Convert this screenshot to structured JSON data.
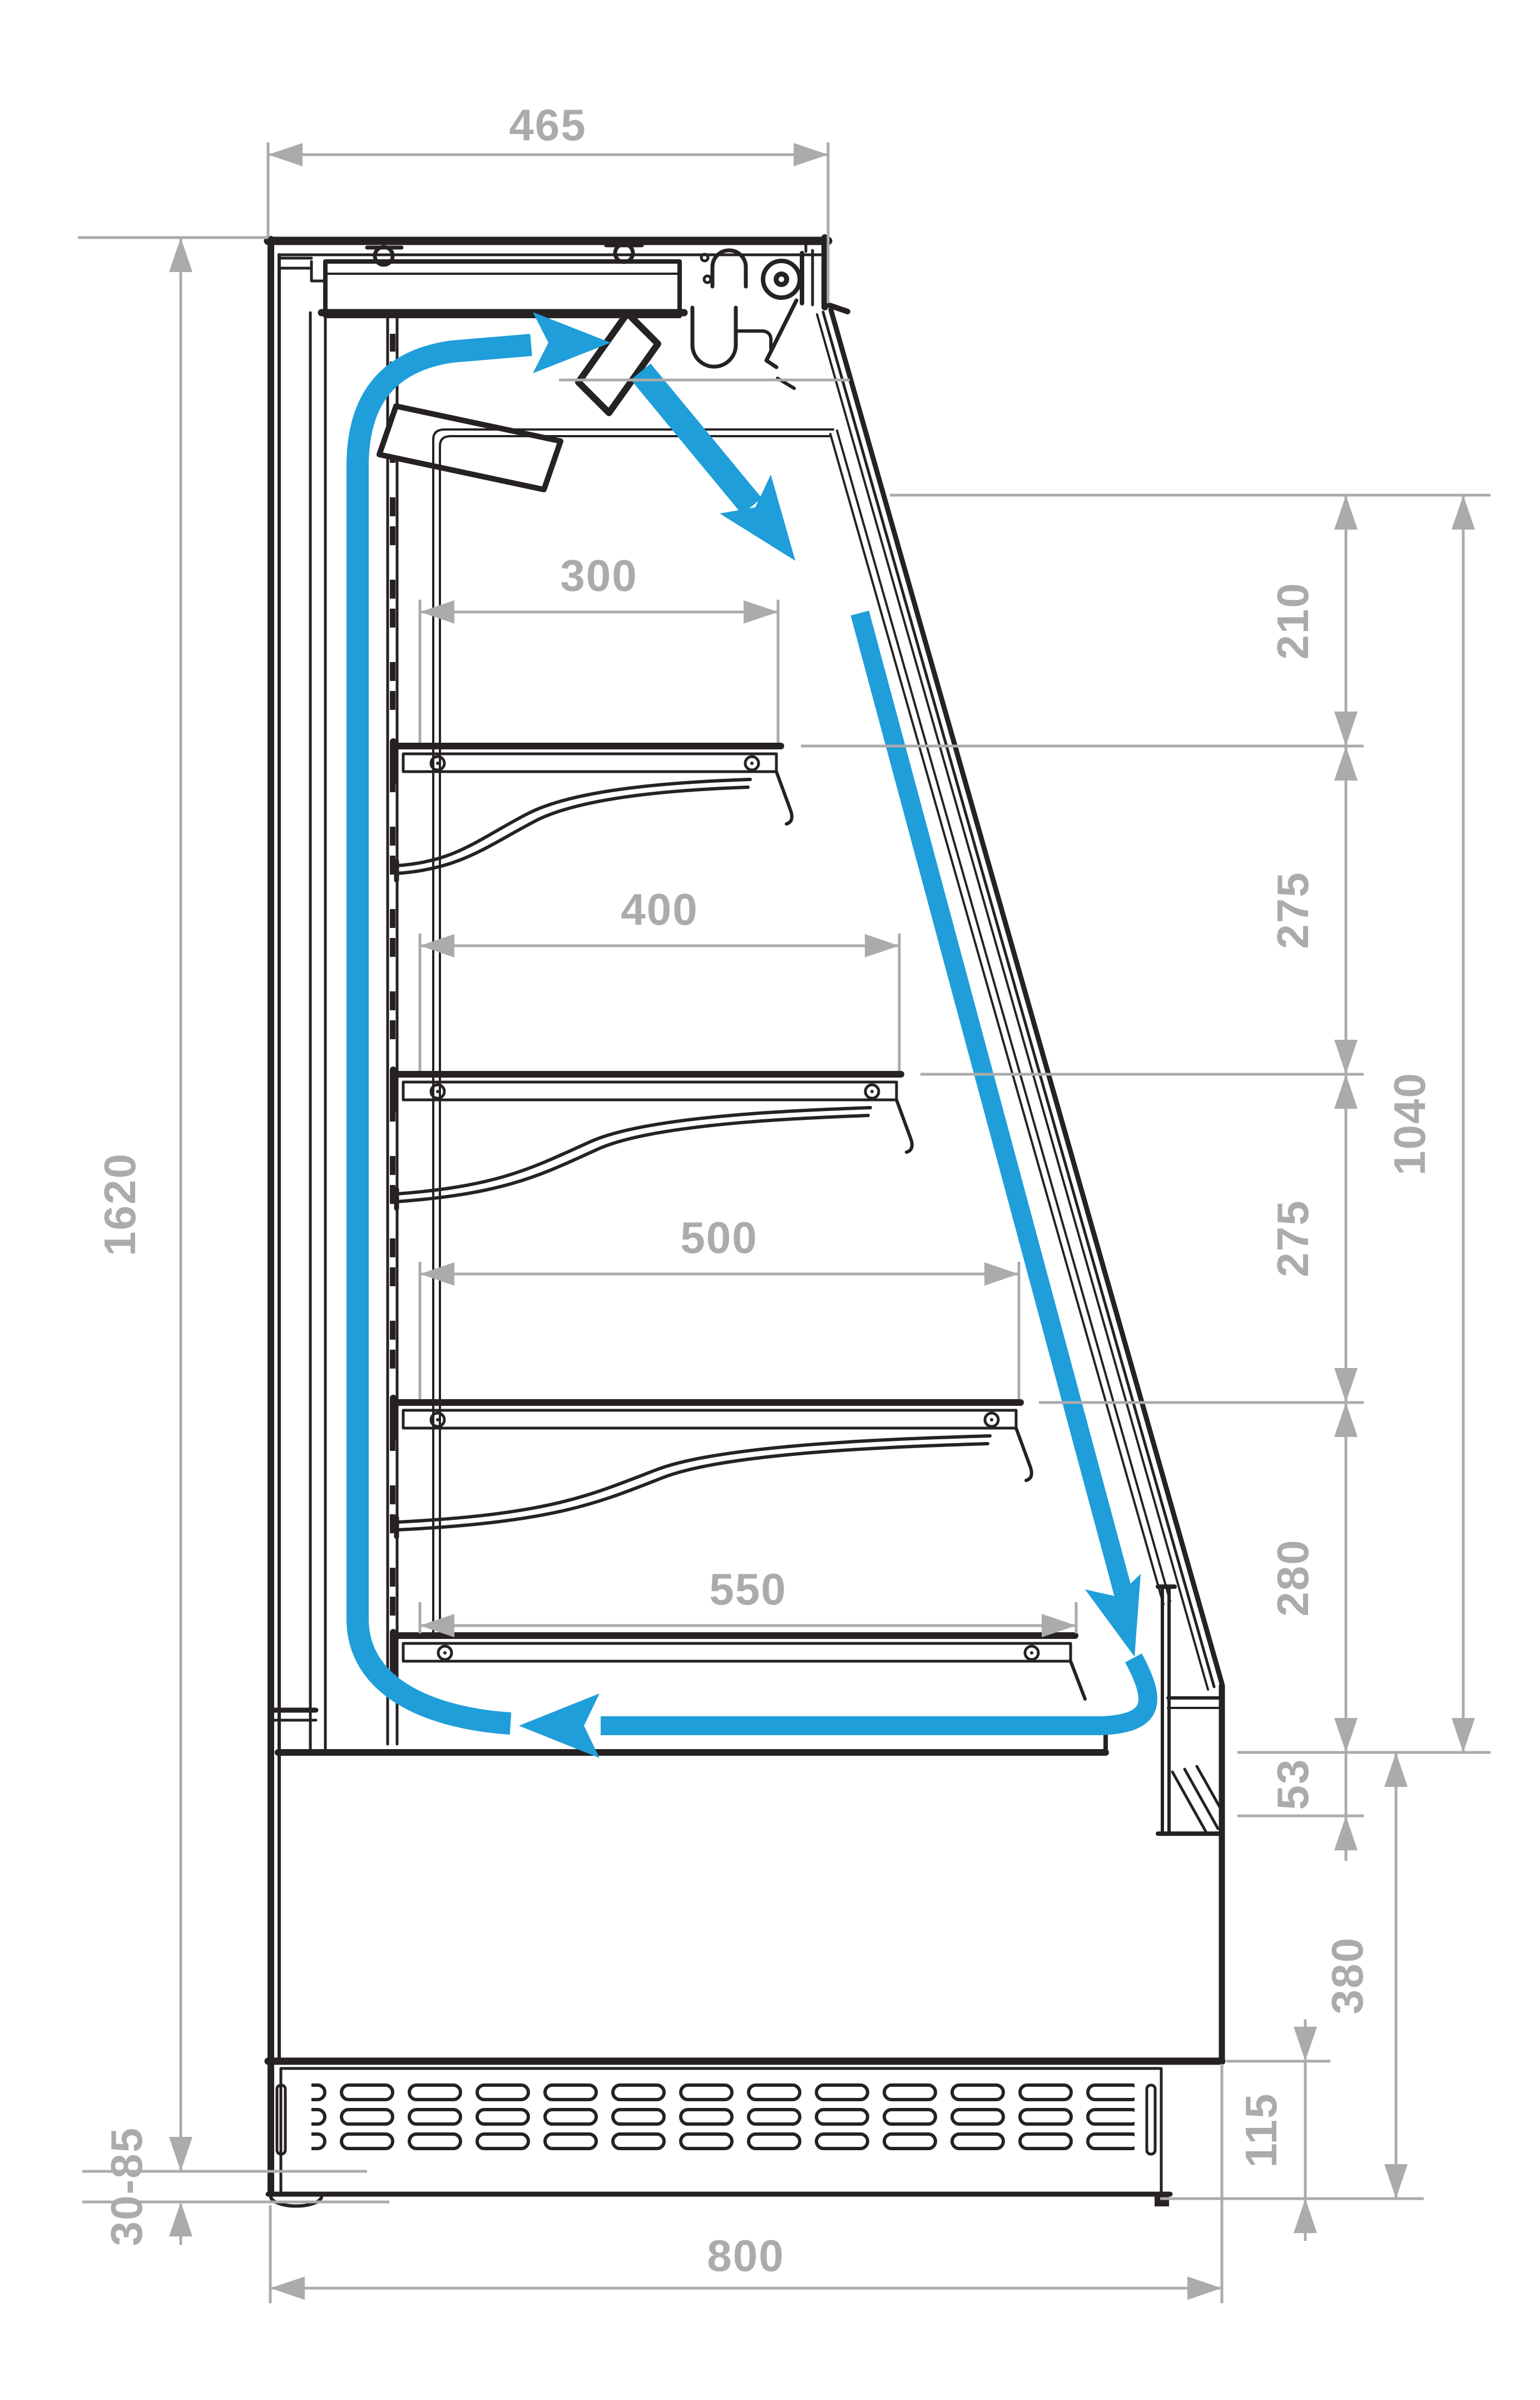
{
  "diagram": {
    "type": "technical-drawing",
    "subject": "refrigerated-open-front-display-case-side-section-with-air-circulation",
    "units": "mm",
    "colors": {
      "outline": "#262223",
      "dimension": "#ababab",
      "airflow": "#1f9ed9",
      "background": "#ffffff"
    },
    "dimensions": {
      "top_width": "465",
      "height_total": "1620",
      "shelf_widths": [
        "300",
        "400",
        "500",
        "550"
      ],
      "right_segments": [
        "210",
        "275",
        "275",
        "280"
      ],
      "right_total": "1040",
      "front_gap": "53",
      "base_height": "380",
      "plinth_height": "115",
      "foot_range": "30-85",
      "depth_total": "800"
    }
  }
}
